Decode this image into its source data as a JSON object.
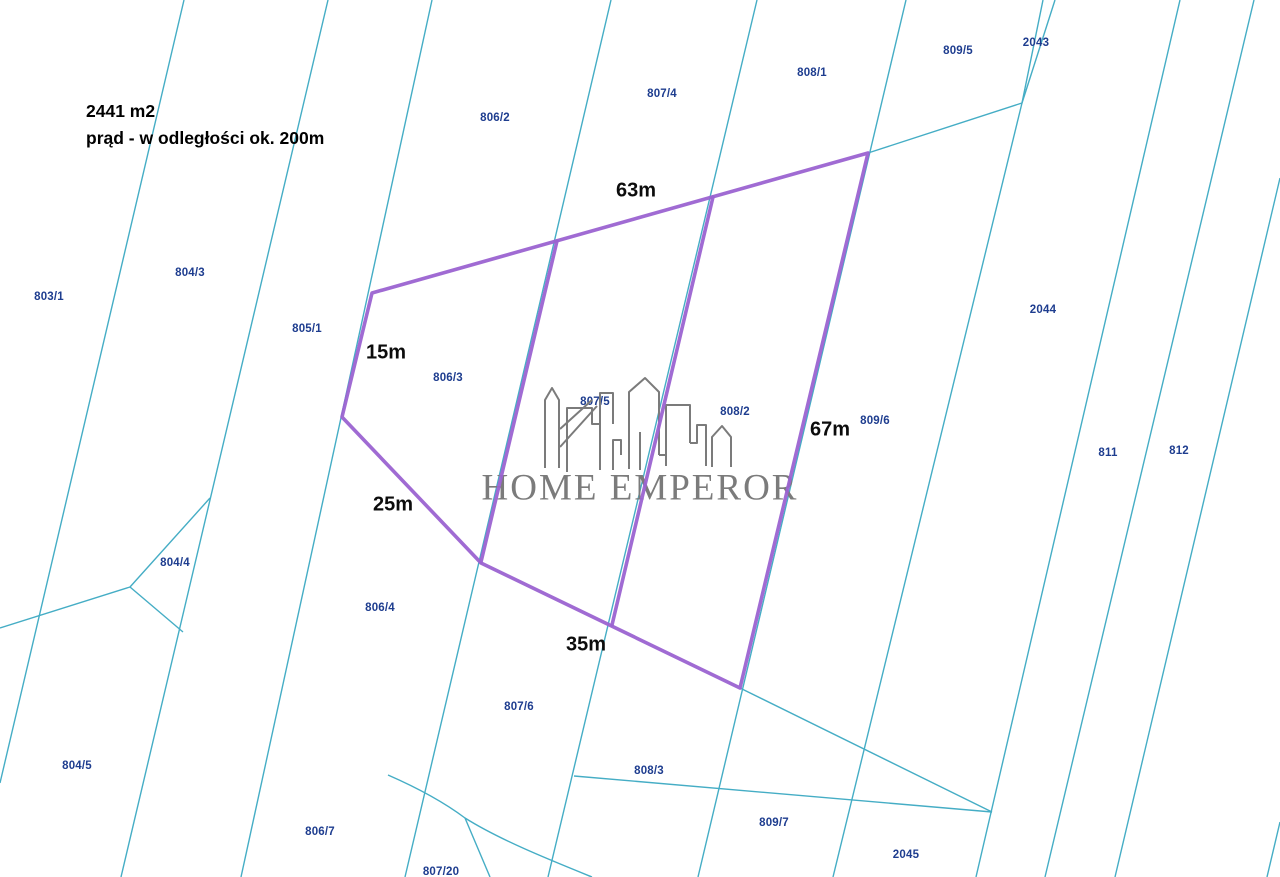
{
  "colors": {
    "background": "#ffffff",
    "parcel_line": "#45adc5",
    "parcel_label": "#1e3d8f",
    "highlight": "#9b63d1",
    "dimension_label": "#0c0c0c",
    "logo": "#7b7b7b"
  },
  "annotation": {
    "area": "2441 m2",
    "note": "prąd - w odległości ok. 200m"
  },
  "logo": {
    "text": "HOME EMPEROR"
  },
  "dimension_labels": [
    {
      "text": "63m",
      "x": 636,
      "y": 191
    },
    {
      "text": "15m",
      "x": 386,
      "y": 353
    },
    {
      "text": "25m",
      "x": 393,
      "y": 505
    },
    {
      "text": "35m",
      "x": 586,
      "y": 645
    },
    {
      "text": "67m",
      "x": 830,
      "y": 430
    }
  ],
  "parcel_labels": [
    {
      "text": "803/1",
      "x": 49,
      "y": 297
    },
    {
      "text": "804/3",
      "x": 190,
      "y": 273
    },
    {
      "text": "805/1",
      "x": 307,
      "y": 329
    },
    {
      "text": "806/2",
      "x": 495,
      "y": 118
    },
    {
      "text": "807/4",
      "x": 662,
      "y": 94
    },
    {
      "text": "808/1",
      "x": 812,
      "y": 73
    },
    {
      "text": "809/5",
      "x": 958,
      "y": 51
    },
    {
      "text": "2043",
      "x": 1036,
      "y": 43
    },
    {
      "text": "2044",
      "x": 1043,
      "y": 310
    },
    {
      "text": "806/3",
      "x": 448,
      "y": 378
    },
    {
      "text": "807/5",
      "x": 595,
      "y": 402
    },
    {
      "text": "808/2",
      "x": 735,
      "y": 412
    },
    {
      "text": "809/6",
      "x": 875,
      "y": 421
    },
    {
      "text": "811",
      "x": 1108,
      "y": 453
    },
    {
      "text": "812",
      "x": 1179,
      "y": 451
    },
    {
      "text": "804/4",
      "x": 175,
      "y": 563
    },
    {
      "text": "806/4",
      "x": 380,
      "y": 608
    },
    {
      "text": "807/6",
      "x": 519,
      "y": 707
    },
    {
      "text": "808/3",
      "x": 649,
      "y": 771
    },
    {
      "text": "804/5",
      "x": 77,
      "y": 766
    },
    {
      "text": "806/7",
      "x": 320,
      "y": 832
    },
    {
      "text": "807/20",
      "x": 441,
      "y": 872
    },
    {
      "text": "809/7",
      "x": 774,
      "y": 823
    },
    {
      "text": "2045",
      "x": 906,
      "y": 855
    }
  ]
}
